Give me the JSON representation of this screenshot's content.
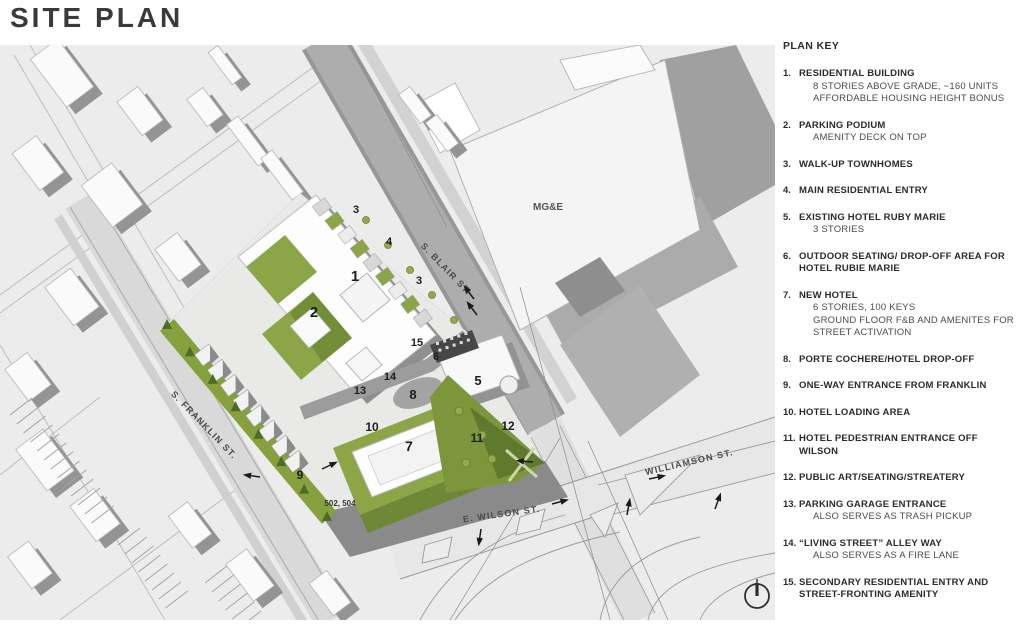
{
  "title": "SITE PLAN",
  "plan_key": {
    "heading": "PLAN KEY",
    "items": [
      {
        "num": "1.",
        "label": "RESIDENTIAL BUILDING",
        "sub": [
          "8 STORIES ABOVE GRADE, ~160 UNITS",
          "AFFORDABLE HOUSING HEIGHT BONUS"
        ]
      },
      {
        "num": "2.",
        "label": "PARKING PODIUM",
        "sub": [
          "AMENITY DECK ON TOP"
        ]
      },
      {
        "num": "3.",
        "label": "WALK-UP TOWNHOMES",
        "sub": []
      },
      {
        "num": "4.",
        "label": "MAIN RESIDENTIAL ENTRY",
        "sub": []
      },
      {
        "num": "5.",
        "label": "EXISTING HOTEL RUBY MARIE",
        "sub": [
          "3 STORIES"
        ]
      },
      {
        "num": "6.",
        "label": "OUTDOOR SEATING/ DROP-OFF AREA FOR HOTEL RUBIE MARIE",
        "sub": []
      },
      {
        "num": "7.",
        "label": "NEW HOTEL",
        "sub": [
          "6 STORIES, 100 KEYS",
          "GROUND FLOOR F&B AND AMENITES FOR",
          "STREET ACTIVATION"
        ]
      },
      {
        "num": "8.",
        "label": "PORTE COCHERE/HOTEL DROP-OFF",
        "sub": []
      },
      {
        "num": "9.",
        "label": "ONE-WAY ENTRANCE FROM FRANKLIN",
        "sub": []
      },
      {
        "num": "10.",
        "label": "HOTEL LOADING AREA",
        "sub": []
      },
      {
        "num": "11.",
        "label": "HOTEL PEDESTRIAN ENTRANCE OFF WILSON",
        "sub": []
      },
      {
        "num": "12.",
        "label": "PUBLIC ART/SEATING/STREATERY",
        "sub": []
      },
      {
        "num": "13.",
        "label": "PARKING GARAGE ENTRANCE",
        "sub": [
          "ALSO SERVES AS TRASH PICKUP"
        ]
      },
      {
        "num": "14.",
        "label": "“LIVING STREET” ALLEY WAY",
        "sub": [
          "ALSO SERVES AS A FIRE LANE"
        ]
      },
      {
        "num": "15.",
        "label": "SECONDARY RESIDENTIAL ENTRY AND STREET-FRONTING AMENITY",
        "sub": []
      }
    ]
  },
  "plan": {
    "street_labels": {
      "blair": "S. BLAIR ST.",
      "franklin": "S. FRANKLIN ST.",
      "wilson": "E. WILSON ST.",
      "williamson": "WILLIAMSON ST."
    },
    "area_labels": {
      "mge": "MG&E",
      "address": "502, 504"
    },
    "markers": [
      {
        "n": "1",
        "x": 355,
        "y": 236,
        "s": 15
      },
      {
        "n": "2",
        "x": 314,
        "y": 272,
        "s": 15
      },
      {
        "n": "3",
        "x": 356,
        "y": 168,
        "s": 11
      },
      {
        "n": "4",
        "x": 389,
        "y": 200,
        "s": 11
      },
      {
        "n": "3",
        "x": 419,
        "y": 239,
        "s": 11
      },
      {
        "n": "15",
        "x": 417,
        "y": 301,
        "s": 11
      },
      {
        "n": "6",
        "x": 436,
        "y": 315,
        "s": 11
      },
      {
        "n": "14",
        "x": 390,
        "y": 335,
        "s": 11
      },
      {
        "n": "13",
        "x": 360,
        "y": 349,
        "s": 11
      },
      {
        "n": "8",
        "x": 413,
        "y": 354,
        "s": 13
      },
      {
        "n": "5",
        "x": 478,
        "y": 340,
        "s": 13
      },
      {
        "n": "10",
        "x": 372,
        "y": 386,
        "s": 12
      },
      {
        "n": "7",
        "x": 409,
        "y": 406,
        "s": 14
      },
      {
        "n": "9",
        "x": 300,
        "y": 434,
        "s": 12
      },
      {
        "n": "11",
        "x": 477,
        "y": 397,
        "s": 12
      },
      {
        "n": "12",
        "x": 508,
        "y": 385,
        "s": 12
      }
    ],
    "arrows": [
      [
        474,
        254,
        233
      ],
      [
        477,
        270,
        233
      ],
      [
        260,
        432,
        188
      ],
      [
        322,
        424,
        -25
      ],
      [
        533,
        417,
        185
      ],
      [
        552,
        459,
        -15
      ],
      [
        481,
        484,
        98
      ],
      [
        627,
        470,
        -80
      ],
      [
        649,
        434,
        -12
      ],
      [
        715,
        464,
        -70
      ]
    ],
    "colors": {
      "background": "#ececec",
      "green": "#8ca647",
      "park_green": "#7d963c",
      "dark_green": "#5f7a2e",
      "shadow": "#8f8f8f",
      "street": "#a9a9a9"
    }
  },
  "compass": {
    "label": "north-arrow"
  }
}
